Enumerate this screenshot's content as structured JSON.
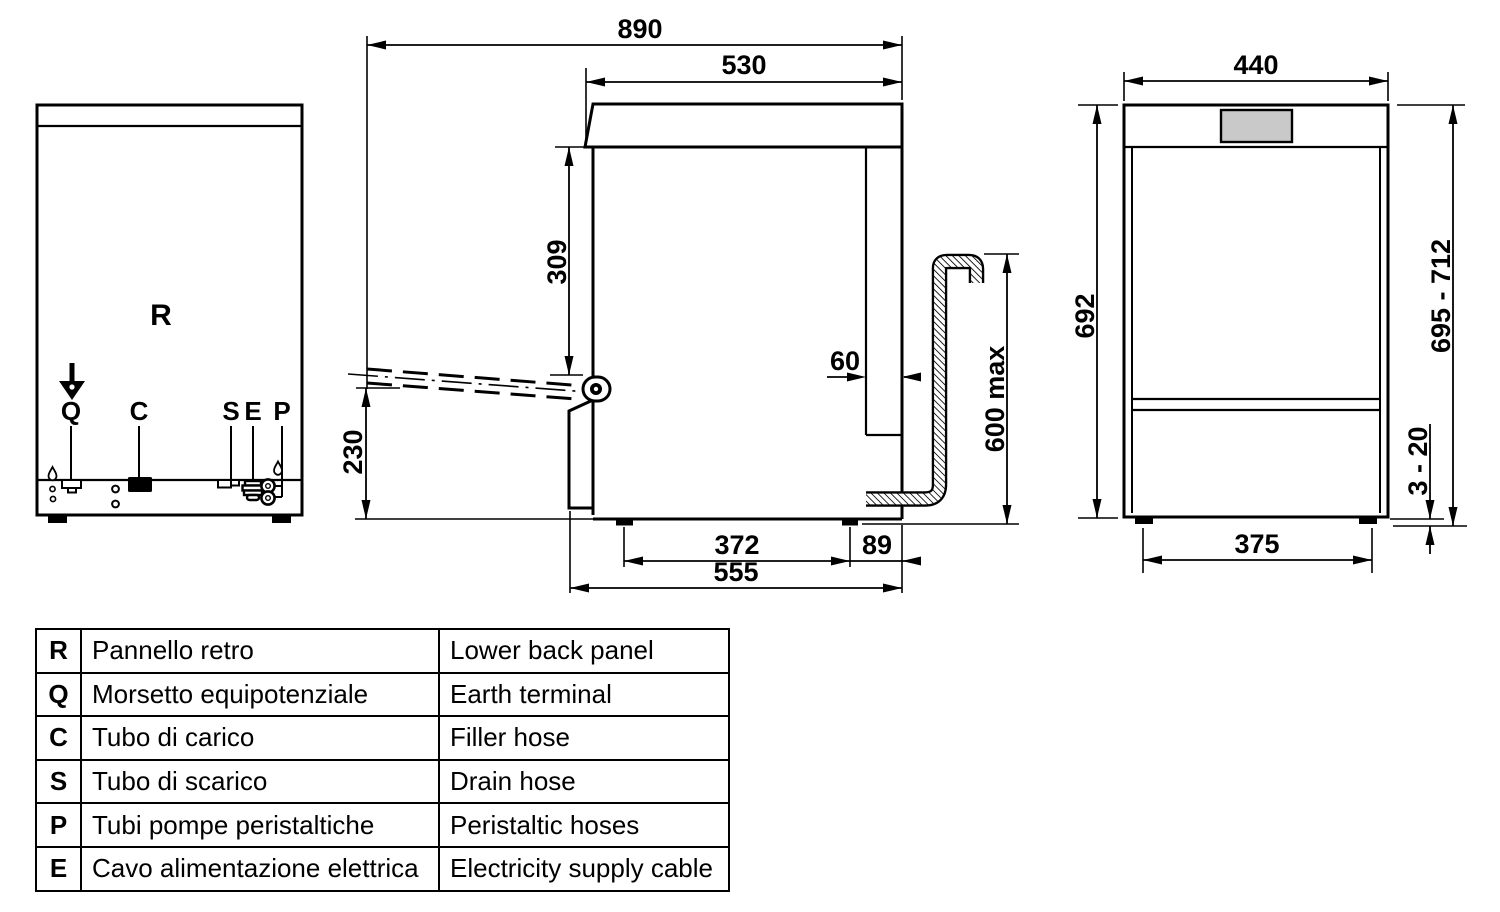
{
  "colors": {
    "line": "#000000",
    "background": "#ffffff",
    "display_fill": "#c9c9c9"
  },
  "rear": {
    "r": "R",
    "q": "Q",
    "c": "C",
    "s": "S",
    "e": "E",
    "p": "P"
  },
  "side": {
    "d890": "890",
    "d530": "530",
    "d309": "309",
    "d230": "230",
    "d60": "60",
    "d600": "600 max",
    "d372": "372",
    "d89": "89",
    "d555": "555"
  },
  "front": {
    "d440": "440",
    "d692": "692",
    "d695": "695 - 712",
    "d320": "3 - 20",
    "d375": "375"
  },
  "legend": {
    "rows": [
      {
        "letter": "R",
        "it": "Pannello retro",
        "en": "Lower back panel"
      },
      {
        "letter": "Q",
        "it": "Morsetto equipotenziale",
        "en": "Earth terminal"
      },
      {
        "letter": "C",
        "it": "Tubo di carico",
        "en": "Filler hose"
      },
      {
        "letter": "S",
        "it": "Tubo di scarico",
        "en": "Drain hose"
      },
      {
        "letter": "P",
        "it": "Tubi pompe peristaltiche",
        "en": "Peristaltic hoses"
      },
      {
        "letter": "E",
        "it": "Cavo alimentazione elettrica",
        "en": "Electricity supply cable"
      }
    ]
  }
}
